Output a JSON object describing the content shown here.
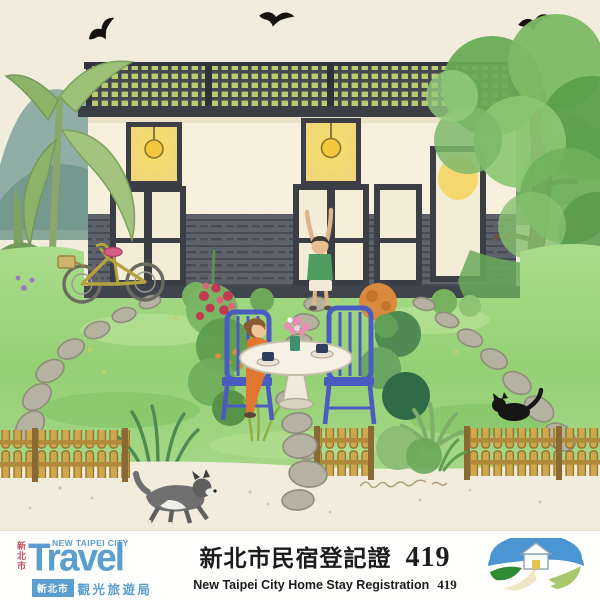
{
  "illustration": {
    "description": "Watercolor painting of a homestay: single-storey house with lattice roof railing and lit windows, garden lawn with stepping-stone paths, woman at a round tea table with blue chairs, child stretching, bicycle, picket fence, black cat, running dog, banana plant, big tree, green mountains and three black birds",
    "colors": {
      "paper": "#f1ecdb",
      "lawn": "#9ed47f",
      "house_frame": "#3b3e45",
      "window_glow": "#f5dc6e",
      "fence": "#cda44d",
      "chair_blue": "#4a5cc0",
      "dress_orange": "#e0762f"
    }
  },
  "label": {
    "registration_title_zh": "新北市民宿登記證",
    "registration_number": "419",
    "registration_title_en": "New Taipei City Home Stay Registration",
    "travel_logo": {
      "city_vertical": "新北市",
      "header": "NEW TAIPEI CITY",
      "wordmark": "Travel",
      "city_box": "新北市",
      "bureau": "觀光旅遊局"
    }
  }
}
